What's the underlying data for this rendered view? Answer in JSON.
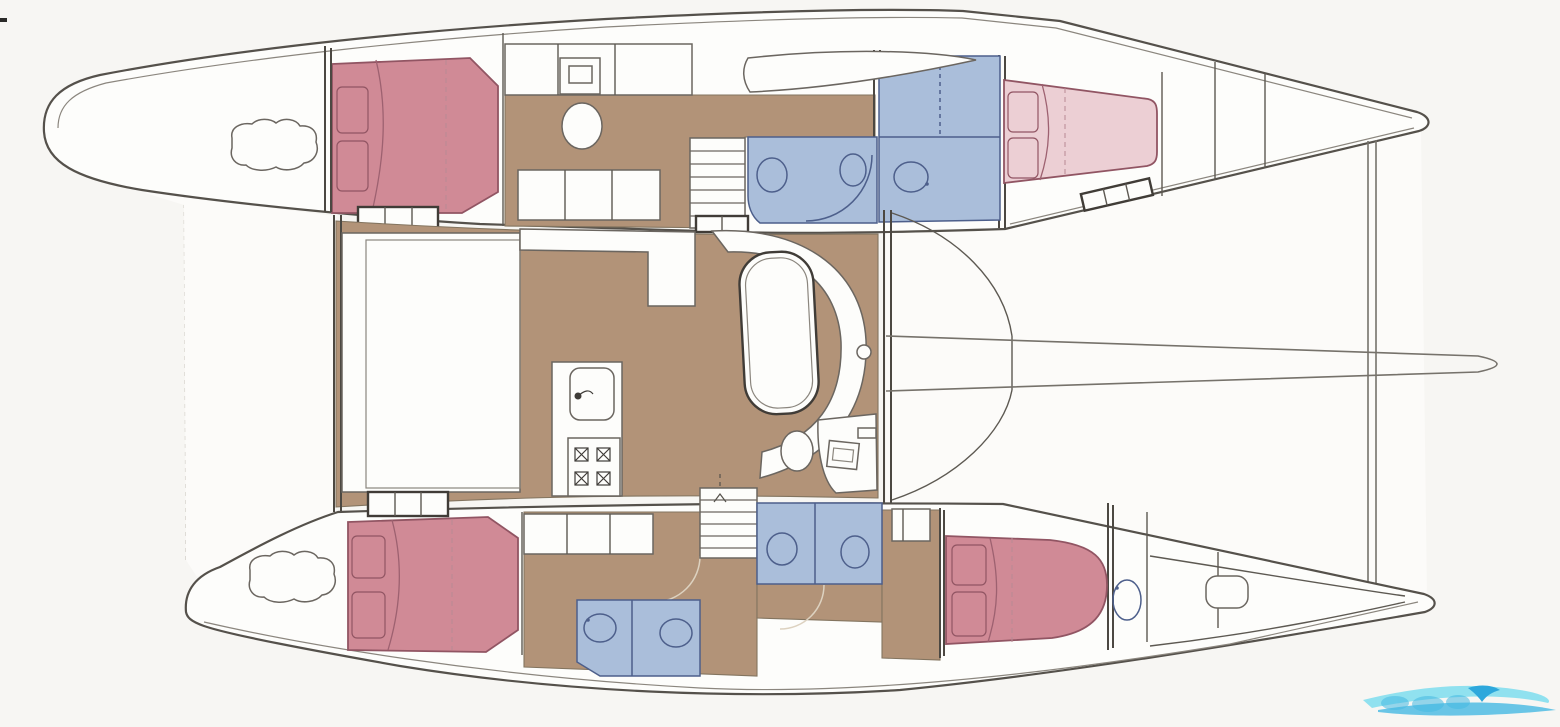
{
  "document": {
    "kind": "boat-deck-plan",
    "description": "Scanned accommodation / layout plan of a sailing catamaran, top-down view with bow to the left, two hulls joined by a central bridgedeck saloon"
  },
  "colors": {
    "background": "#f7f6f3",
    "paper_white": "#fdfdfb",
    "ink": "#55514b",
    "floor_wood": "#b29378",
    "bed_red": "#d08a96",
    "bed_pink": "#eccfd4",
    "bath_blue": "#aabeda",
    "bath_ink": "#4d5f8b",
    "watermark_light": "#7edded",
    "watermark_mid": "#45b9e2",
    "watermark_deep": "#2ea8dc"
  },
  "plan": {
    "hull_top": {
      "rooms": [
        "bow-deck with windlass",
        "forward double cabin (red berth)",
        "corridor with vanity seat and lockers",
        "bathroom: shower + WC",
        "bathroom: washbasin",
        "aft double cabin (pink berth)",
        "stern lockers"
      ],
      "extras": [
        "kayak stored on deck",
        "companionway stairs to saloon"
      ]
    },
    "hull_bottom": {
      "rooms": [
        "bow-deck with windlass",
        "forward double cabin (red berth)",
        "forward bathroom (basin + WC)",
        "companionway stairs to saloon",
        "aft bathroom (two WC compartments)",
        "aft double cabin (red berth)",
        "washbasin alcove",
        "stern compartment with hatch"
      ]
    },
    "bridgedeck": {
      "rooms": [
        "foredeck platform",
        "saloon seating platform",
        "galley counter with sink",
        "galley stove with 4 burners",
        "dinette oval table with curved settee",
        "stool",
        "navigation station with screen",
        "aft cockpit with curved benches"
      ]
    },
    "rig": [
      "boom drawn over aft deck",
      "aft crossbeam between sterns",
      "faint forward trampoline outline"
    ],
    "counts": {
      "double_berths": 4,
      "bathroom_zones": 4,
      "stove_burners": 4,
      "stair_sets": 2
    }
  },
  "watermark": {
    "style": "light blue wave logo, bottom-right corner, partially cropped, lettering illegible"
  }
}
